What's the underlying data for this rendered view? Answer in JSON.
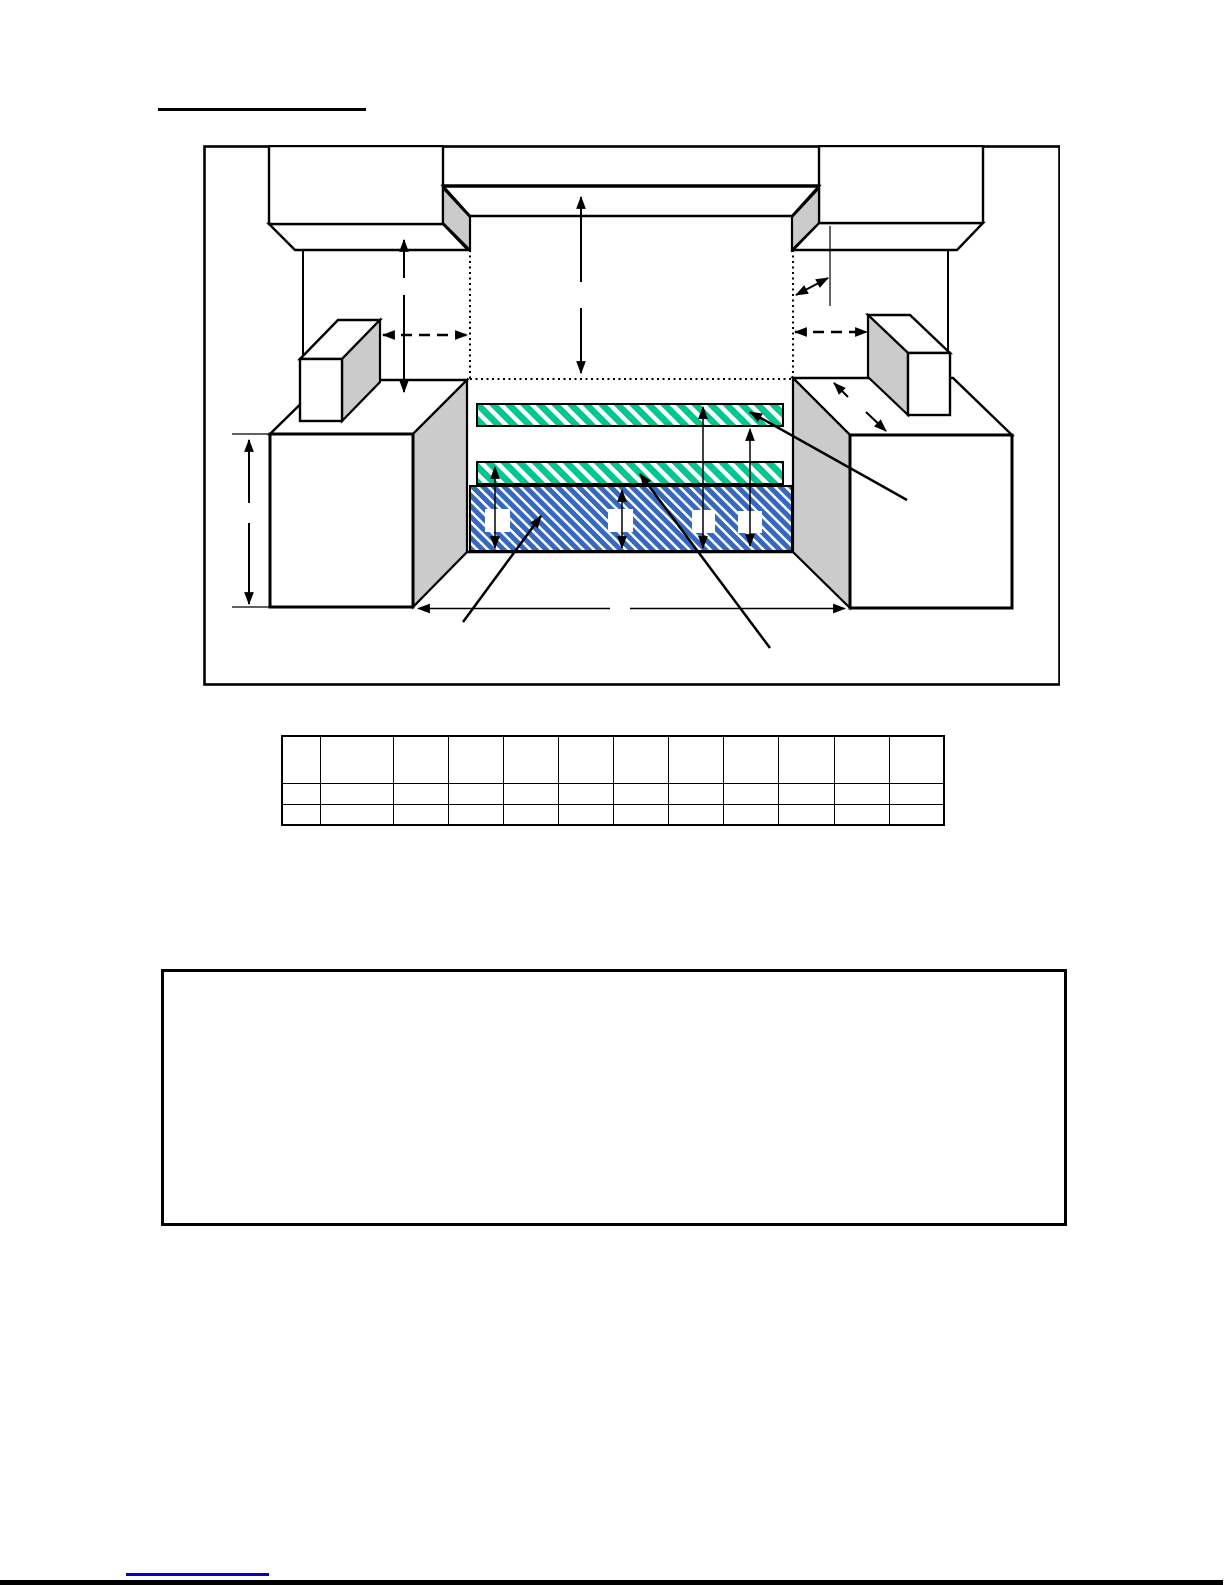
{
  "page": {
    "width": 1225,
    "height": 1585,
    "background": "#ffffff"
  },
  "heading": {
    "text": ""
  },
  "diagram": {
    "colors": {
      "hatch_green": "#00c692",
      "hatch_blue": "#3568be",
      "face_gray": "#cbcbcb",
      "line_black": "#000000"
    }
  },
  "table": {
    "rows": [
      [
        "",
        "",
        "",
        "",
        "",
        "",
        "",
        "",
        "",
        "",
        "",
        ""
      ],
      [
        "",
        "",
        "",
        "",
        "",
        "",
        "",
        "",
        "",
        "",
        "",
        ""
      ],
      [
        "",
        "",
        "",
        "",
        "",
        "",
        "",
        "",
        "",
        "",
        "",
        ""
      ]
    ]
  },
  "note_box": {
    "text": ""
  },
  "footer": {
    "link_text": "",
    "link_color": "#0000cc"
  }
}
